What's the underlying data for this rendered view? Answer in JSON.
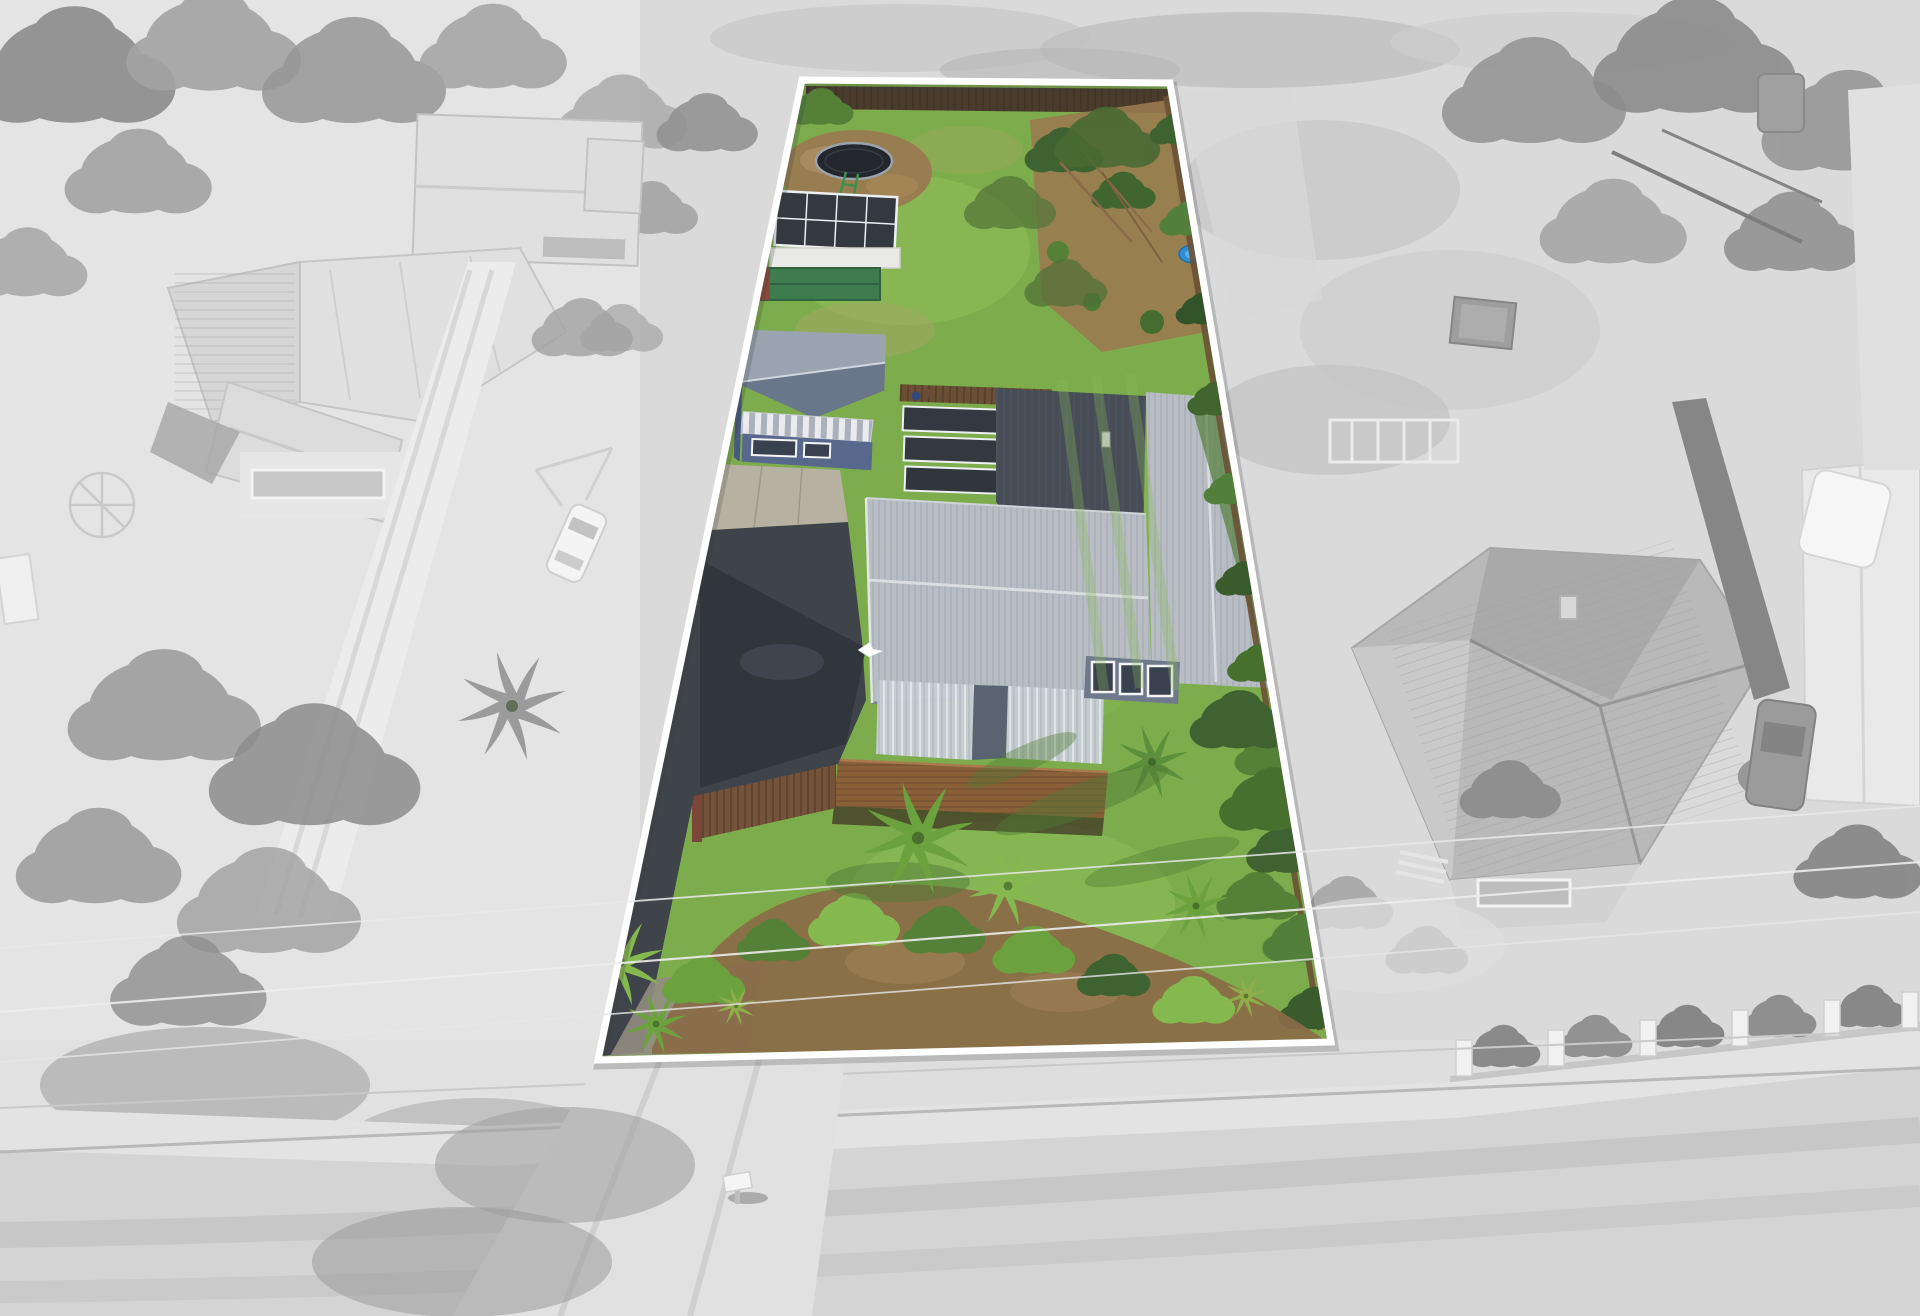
{
  "meta": {
    "image_width": 1920,
    "image_height": 1316,
    "style": "real-estate aerial drone photograph, property shown in full colour with white boundary outline, surroundings desaturated grey"
  },
  "boundary": {
    "points": "802,80 1170,83 1331,1042 598,1060",
    "stroke_width": 7
  },
  "scene": {
    "type": "aerial property photo",
    "lot_features": [
      "back lawn",
      "trampoline on bare dirt patch",
      "timber back fence",
      "glasshouse",
      "green garden shed",
      "blue sleepout garage with striped awning and windows",
      "dark glazed pergola panels",
      "main house with grey corrugated iron gable roof",
      "dark rear roof wing",
      "translucent veranda roof panels",
      "bay window",
      "timber deck and brown paling fence",
      "long asphalt driveway with concrete apron",
      "gravel lower driveway",
      "palm trees along west boundary",
      "front lawn",
      "front garden bed with palms, shrubs and mulch",
      "clipped hedge along east boundary",
      "small blue paddling pool",
      "white bird in flight",
      "two people sitting by the fence"
    ],
    "surroundings": [
      "left neighbour house with pale metal roof",
      "left neighbour garage",
      "rotary clothesline",
      "white station wagon",
      "gravel shared driveway",
      "right neighbour house with grey tiled hip roof",
      "dark van",
      "caravan",
      "dark hatchback",
      "white house at right edge",
      "row of white front-fence posts with shrubs",
      "grass verge",
      "concrete footpath",
      "street",
      "white letterbox",
      "power lines",
      "mature trees and shadows"
    ]
  },
  "colors": {
    "boundary": "#ffffff",
    "gray_base": "#dadada",
    "gray_wash": "#e7e7e7",
    "gray_tree": "#a3a3a3",
    "gray_tree_dark": "#8c8c8c",
    "gray_roof": "#e0e0e0",
    "gray_tile_roof": "#b9b9b9",
    "gray_road": "#d4d4d4",
    "gray_path": "#e3e3e3",
    "gray_shadow": "#a5a5a5",
    "lawn": "#7dac4c",
    "lawn_light": "#8fc05a",
    "lawn_front": "#77ad45",
    "lawn_dry": "#a3a765",
    "dirt": "#9a7a50",
    "mulch": "#8a6a46",
    "hedge_dark": "#3f6330",
    "hedge_mid": "#548038",
    "palm_green": "#6ba23e",
    "palm_light": "#85b84e",
    "asphalt": "#3f444b",
    "asphalt_dark": "#2f343a",
    "gravel": "#928d82",
    "concrete": "#b7b1a1",
    "house_roof": "#b7bdc3",
    "house_roof_dark": "#474d57",
    "veranda": "#c6cdd3",
    "house_wall": "#6e798c",
    "window_glass": "#39414e",
    "window_frame": "#f2f4f6",
    "deck": "#8a6038",
    "deck_fence": "#75523a",
    "garage_roof": "#6a7689",
    "garage_roof_light": "#9aa4b1",
    "garage_wall": "#57688c",
    "shed_green": "#3e7c50",
    "glass_panel": "#34393f",
    "frame_white": "#edf0f2",
    "trampoline_mat": "#23262c",
    "trampoline_rim": "#9aa3ab",
    "pool_blue": "#2e8fd6",
    "back_fence": "#4a3c2c",
    "fence_brown": "#6b4f35",
    "wire": "#e9e9e9",
    "bird_white": "#ffffff"
  }
}
